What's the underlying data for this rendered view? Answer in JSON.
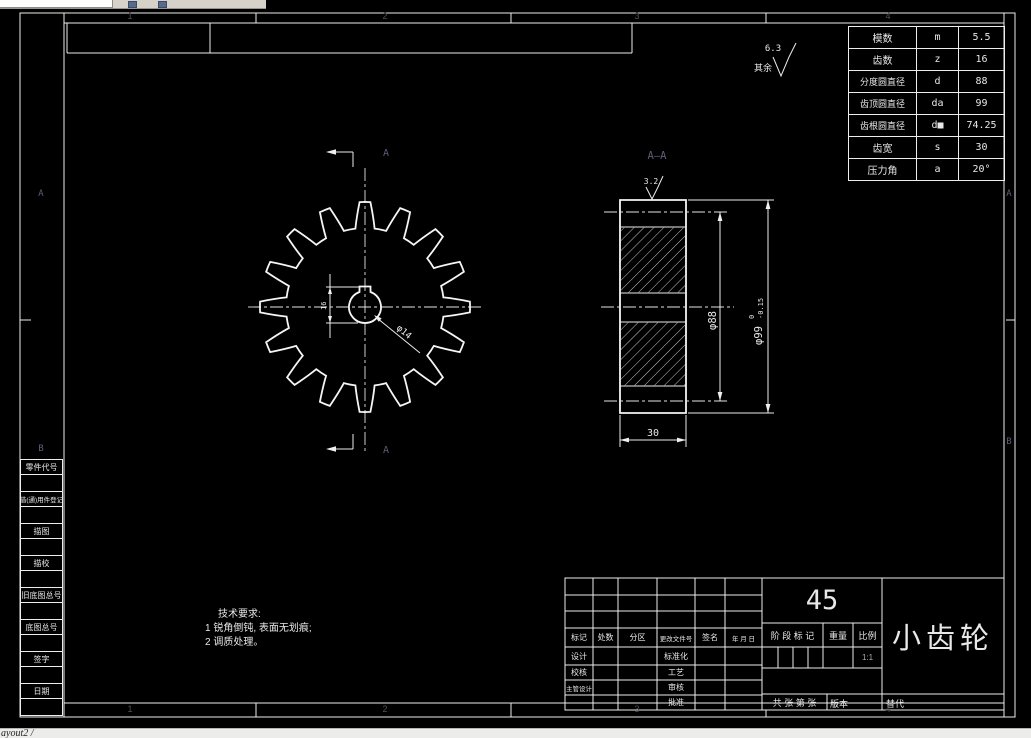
{
  "window": {
    "top_input_tooltip": "command-input",
    "bottom_tab_label": "ayout2 /"
  },
  "frame": {
    "zone_numbers": [
      "1",
      "2",
      "3",
      "4"
    ],
    "zone_letters": [
      "A",
      "B"
    ],
    "zone_color": "#50505e"
  },
  "param_table": {
    "rows": [
      {
        "name": "模数",
        "sym": "m",
        "val": "5.5"
      },
      {
        "name": "齿数",
        "sym": "z",
        "val": "16"
      },
      {
        "name": "分度圆直径",
        "sym": "d",
        "val": "88"
      },
      {
        "name": "齿顶圆直径",
        "sym": "da",
        "val": "99"
      },
      {
        "name": "齿根圆直径",
        "sym": "d■",
        "val": "74.25"
      },
      {
        "name": "齿宽",
        "sym": "s",
        "val": "30"
      },
      {
        "name": "压力角",
        "sym": "a",
        "val": "20°"
      }
    ]
  },
  "surface_note": {
    "label": "其余",
    "value": "6.3"
  },
  "tech_req": {
    "title": "技术要求:",
    "lines": [
      "1 锐角倒钝, 表面无划痕;",
      "2 调质处理。"
    ]
  },
  "front_view": {
    "section_label": "A",
    "keyway_dim": "16",
    "bore_label": "φ14"
  },
  "section_view": {
    "title": "A—A",
    "roughness": "3.2",
    "dim_width": "30",
    "dim_pitch": "φ88",
    "dim_tip": "φ99",
    "dim_tip_tol_upper": "0",
    "dim_tip_tol_lower": "-0.15"
  },
  "gear": {
    "teeth": 16
  },
  "title_block": {
    "material": "45",
    "part_name": "小齿轮",
    "rev_headers": [
      "标记",
      "处数",
      "分区",
      "更改文件号",
      "签名",
      "年 月 日"
    ],
    "sign_rows": [
      [
        "设计",
        "标准化"
      ],
      [
        "校核",
        "工艺"
      ],
      [
        "主管设计",
        "审核"
      ],
      [
        "",
        "批准"
      ]
    ],
    "stage_label": "阶 段 标 记",
    "weight_label": "重量",
    "scale_label": "比例",
    "scale_value": "1:1",
    "sheet_label": "共  张 第  张",
    "version_label": "版本",
    "replace_label": "替代"
  },
  "margin_boxes": [
    "零件代号",
    "借(通)用件登记",
    "描图",
    "描校",
    "旧底图总号",
    "底图总号",
    "签字",
    "日期"
  ]
}
